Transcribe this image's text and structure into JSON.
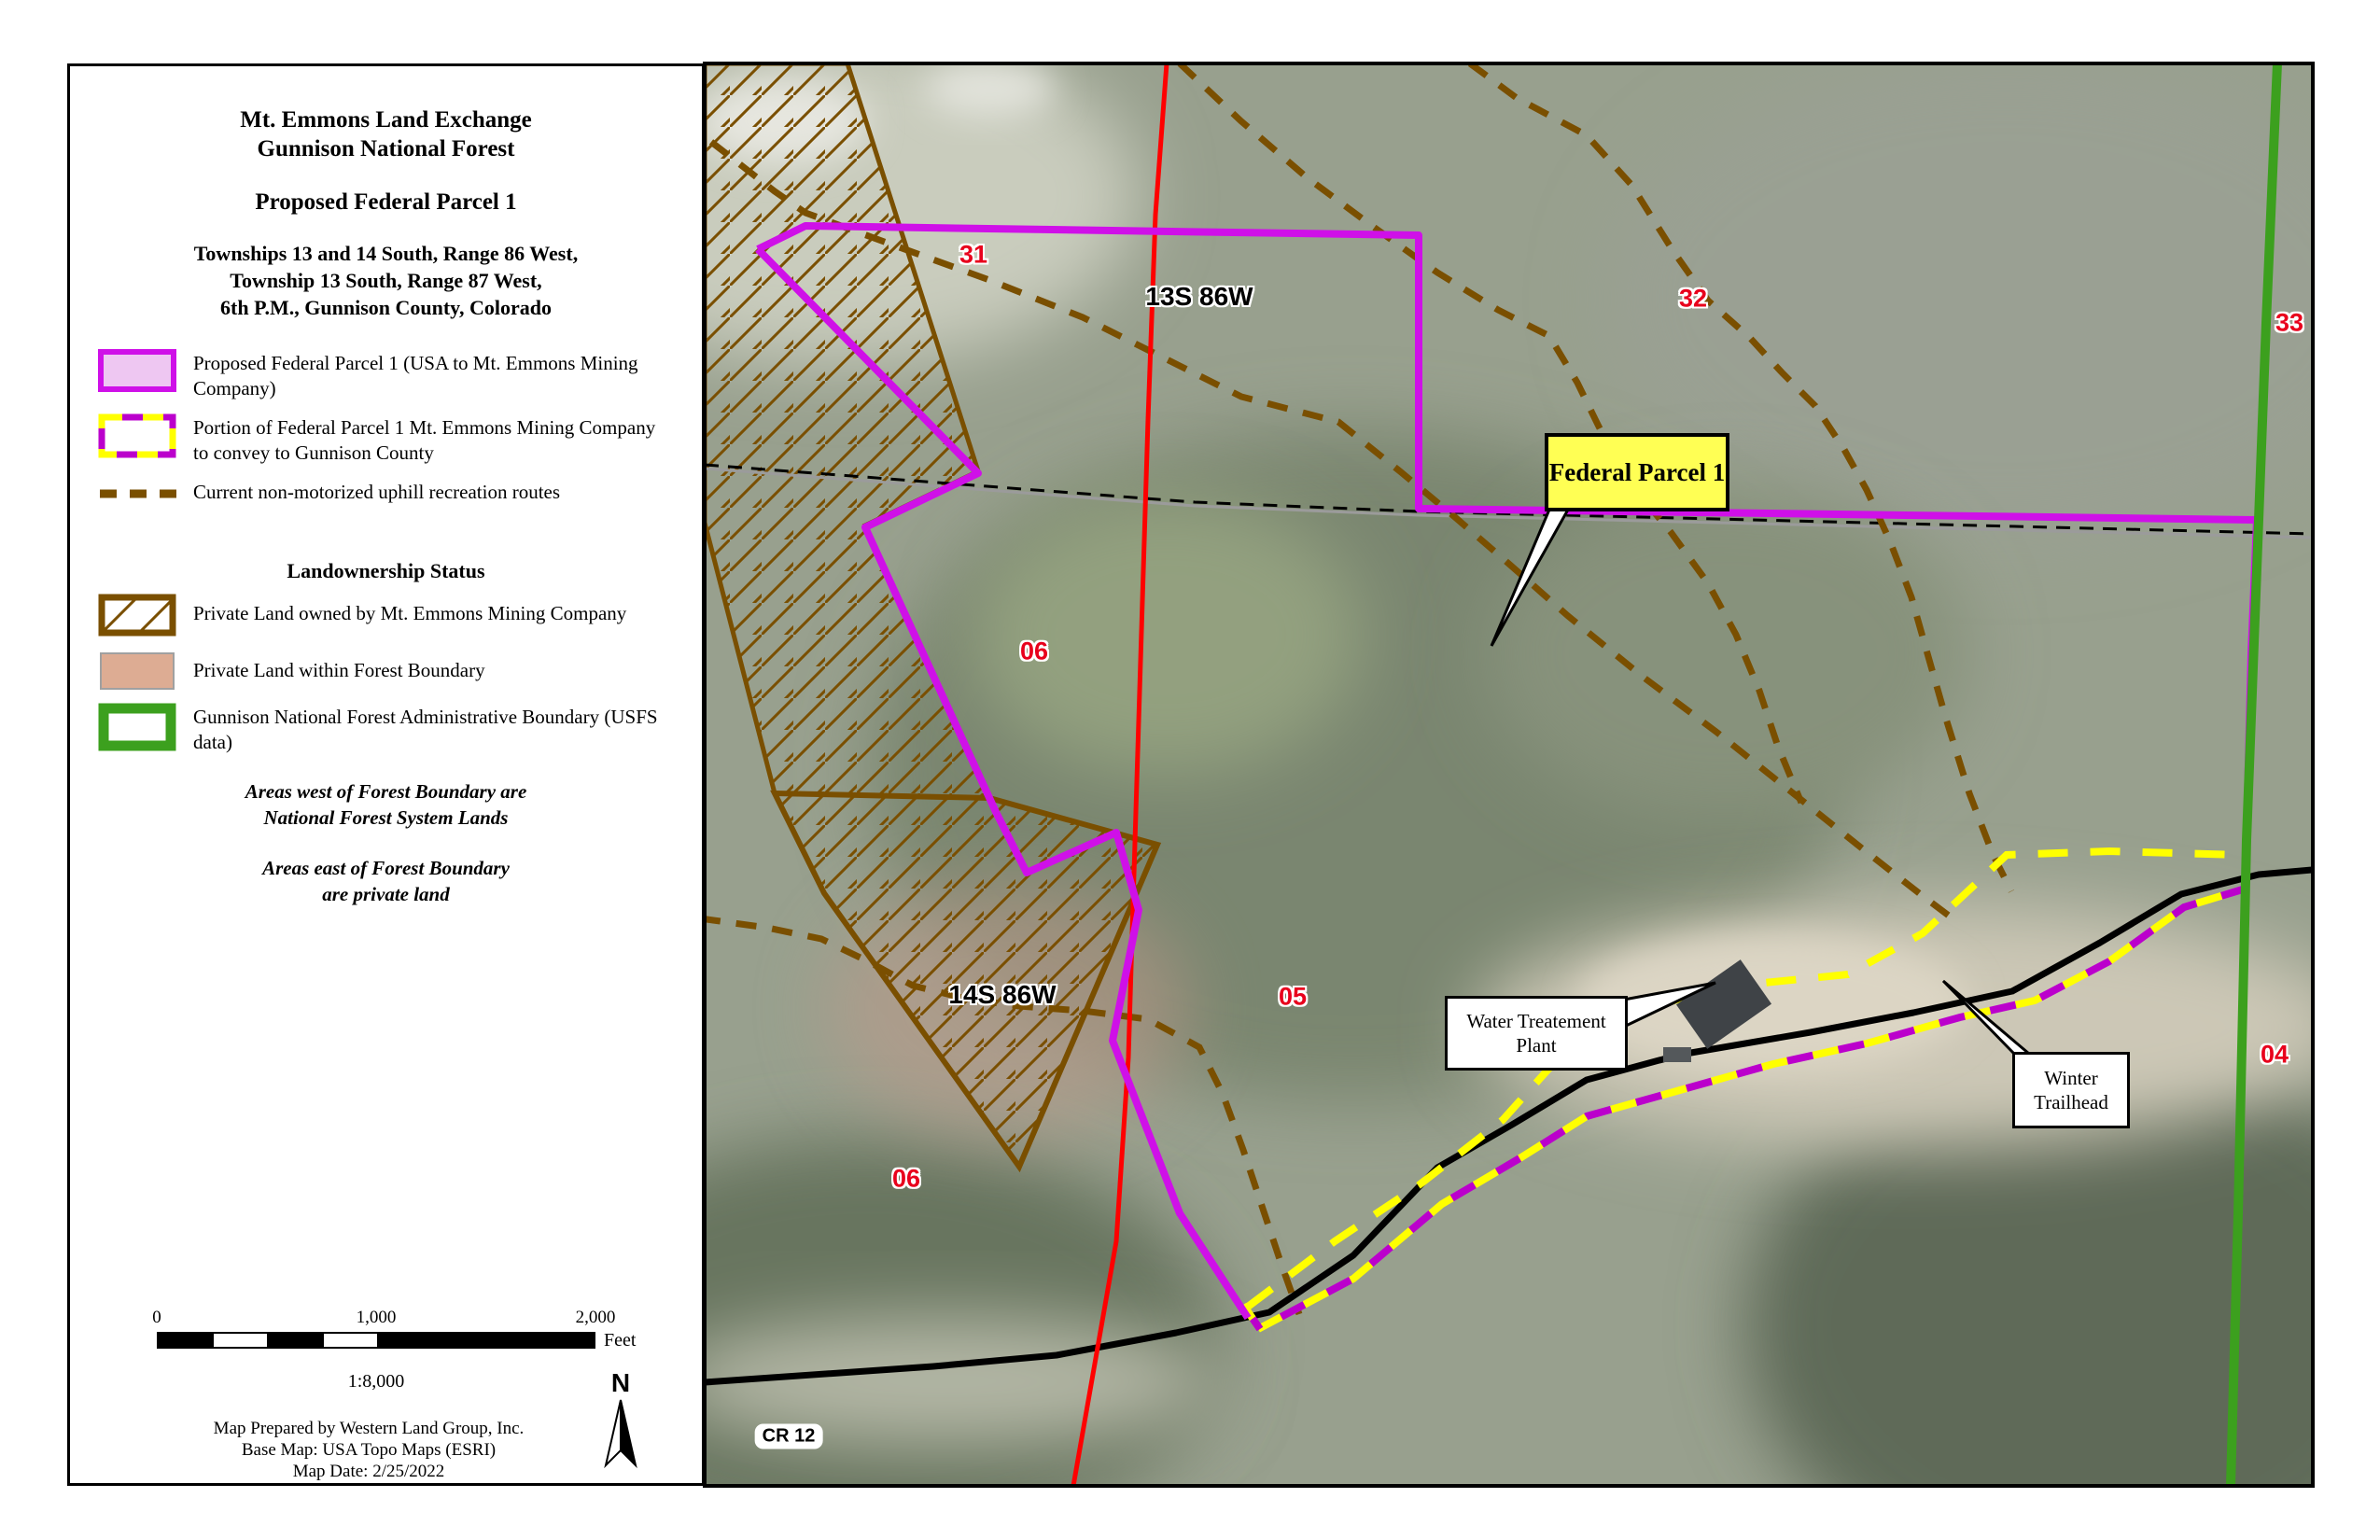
{
  "title": {
    "line1": "Mt. Emmons Land Exchange",
    "line2": "Gunnison National Forest",
    "subtitle": "Proposed Federal Parcel 1",
    "township_lines": [
      "Townships 13 and 14 South, Range 86 West,",
      "Township 13 South, Range 87 West,",
      "6th P.M., Gunnison County, Colorado"
    ]
  },
  "legend": {
    "items": [
      {
        "label": "Proposed Federal Parcel 1 (USA to Mt. Emmons Mining Company)"
      },
      {
        "label": "Portion of Federal Parcel 1 Mt. Emmons Mining Company to convey to Gunnison County"
      },
      {
        "label": "Current non-motorized uphill recreation routes"
      },
      {
        "label": "Private Land owned by Mt. Emmons Mining Company"
      },
      {
        "label": "Private Land within Forest Boundary"
      },
      {
        "label": "Gunnison National Forest Administrative Boundary (USFS data)"
      }
    ],
    "landownership_heading": "Landownership Status",
    "notes": [
      "Areas west of Forest Boundary are",
      "National Forest System Lands",
      "Areas east of Forest Boundary",
      "are private land"
    ]
  },
  "scalebar": {
    "ticks": [
      "0",
      "1,000",
      "2,000"
    ],
    "unit": "Feet",
    "ratio": "1:8,000"
  },
  "credits": {
    "lines": [
      "Map Prepared by Western Land Group, Inc.",
      "Base Map: USA Topo Maps (ESRI)",
      "Map Date: 2/25/2022"
    ]
  },
  "north": {
    "label": "N"
  },
  "map": {
    "section_labels": [
      {
        "text": "31"
      },
      {
        "text": "32"
      },
      {
        "text": "33"
      },
      {
        "text": "04"
      },
      {
        "text": "05"
      },
      {
        "text": "06"
      },
      {
        "text": "06"
      }
    ],
    "township_labels": [
      {
        "text": "13S 86W"
      },
      {
        "text": "14S 86W"
      }
    ],
    "road_label": "CR 12",
    "parcel_callout": "Federal Parcel 1",
    "water_callout": [
      "Water Treatement",
      "Plant"
    ],
    "winter_callout": [
      "Winter",
      "Trailhead"
    ]
  },
  "colors": {
    "parcel_magenta": "#cf10e8",
    "parcel_fill": "#eec7f2",
    "convey_yellow": "#ffff00",
    "convey_magenta": "#bb00cc",
    "trail_brown": "#7a4f00",
    "forest_green": "#3ca01e",
    "range_red": "#ff0000",
    "private_salmon": "#dba violet",
    "salmon_fill": "#dfa globe"
  }
}
